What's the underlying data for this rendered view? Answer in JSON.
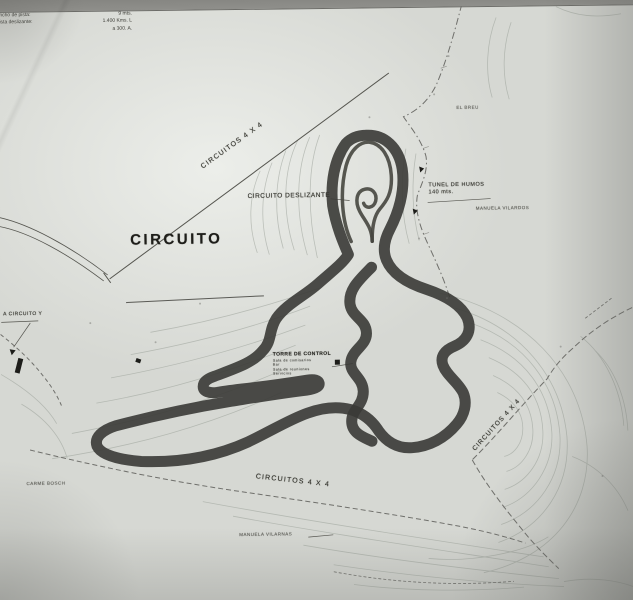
{
  "map": {
    "title": "CIRCUITO",
    "specs": [
      {
        "label": "Longitud Circuito asfalto:",
        "value": "3.350 k.m."
      },
      {
        "label": "Ancho de pista:",
        "value": "9 mts."
      },
      {
        "label": "Pista deslizante:",
        "value": "1.400 Kms. L"
      },
      {
        "label": "",
        "value": "a 300. A."
      }
    ],
    "labels": {
      "circuito_deslizante": "CIRCUITO DESLIZANTE",
      "tunel_line1": "TUNEL DE HUMOS",
      "tunel_line2": "140 mts.",
      "road_4x4": "CIRCUITOS 4 X 4",
      "el_breu": "EL BREU",
      "manuela_vilardos": "MANUELA VILARDOS",
      "manuela_vilarnas": "MANUELA VILARNAS",
      "carme_bosch": "CARME BOSCH",
      "a_circuito": "A CIRCUITO Y",
      "torre_title": "TORRE DE CONTROL",
      "torre_lines": [
        "Sala de comisarios",
        "Bar",
        "Sala de reuniones",
        "Servicios"
      ]
    },
    "colors": {
      "paper": "#d6d8d3",
      "track": "#3a3a36",
      "contour": "#a7ada5",
      "boundary": "#6f6f6b"
    }
  }
}
